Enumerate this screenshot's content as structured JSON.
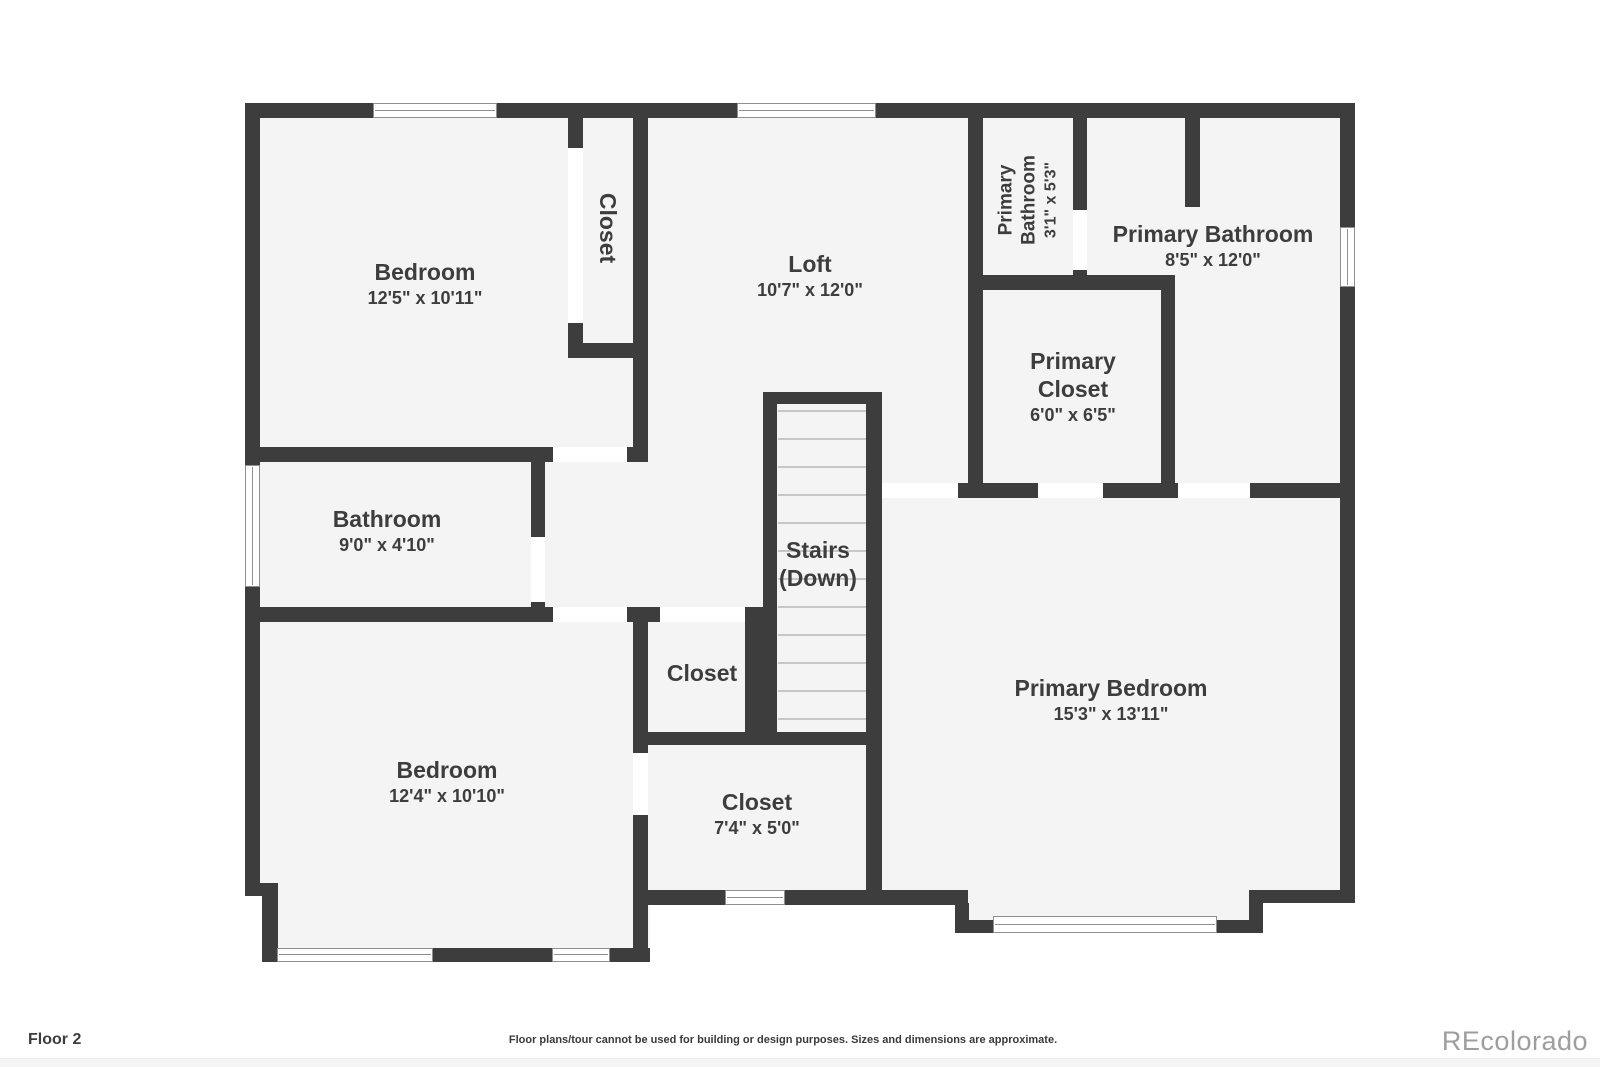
{
  "colors": {
    "wall": "#3d3d3d",
    "room_fill": "#f4f4f4",
    "door_gap": "#ffffff",
    "window_frame": "#8f8f8f",
    "stair_tread": "#c7c7c7",
    "label_text": "#3d3d3d",
    "brand_gray": "#9e9e9e"
  },
  "rooms": {
    "bedroom_top_left": {
      "name": "Bedroom",
      "dims": "12'5\" x 10'11\""
    },
    "closet_top_left": {
      "name": "Closet"
    },
    "loft": {
      "name": "Loft",
      "dims": "10'7\" x 12'0\""
    },
    "primary_bathroom_small": {
      "name": "Primary Bathroom",
      "dims": "3'1\" x 5'3\""
    },
    "primary_bathroom": {
      "name": "Primary Bathroom",
      "dims": "8'5\" x 12'0\""
    },
    "primary_closet": {
      "name": "Primary Closet",
      "dims": "6'0\" x 6'5\""
    },
    "bathroom": {
      "name": "Bathroom",
      "dims": "9'0\" x 4'10\""
    },
    "stairs": {
      "name": "Stairs",
      "sub": "(Down)"
    },
    "closet_center": {
      "name": "Closet"
    },
    "bedroom_bottom_left": {
      "name": "Bedroom",
      "dims": "12'4\" x 10'10\""
    },
    "closet_bottom": {
      "name": "Closet",
      "dims": "7'4\" x 5'0\""
    },
    "primary_bedroom": {
      "name": "Primary Bedroom",
      "dims": "15'3\" x 13'11\""
    }
  },
  "footer": {
    "floor_label": "Floor 2",
    "disclaimer": "Floor plans/tour cannot be used for building or design purposes. Sizes and dimensions are approximate.",
    "brand": "REcolorado"
  }
}
